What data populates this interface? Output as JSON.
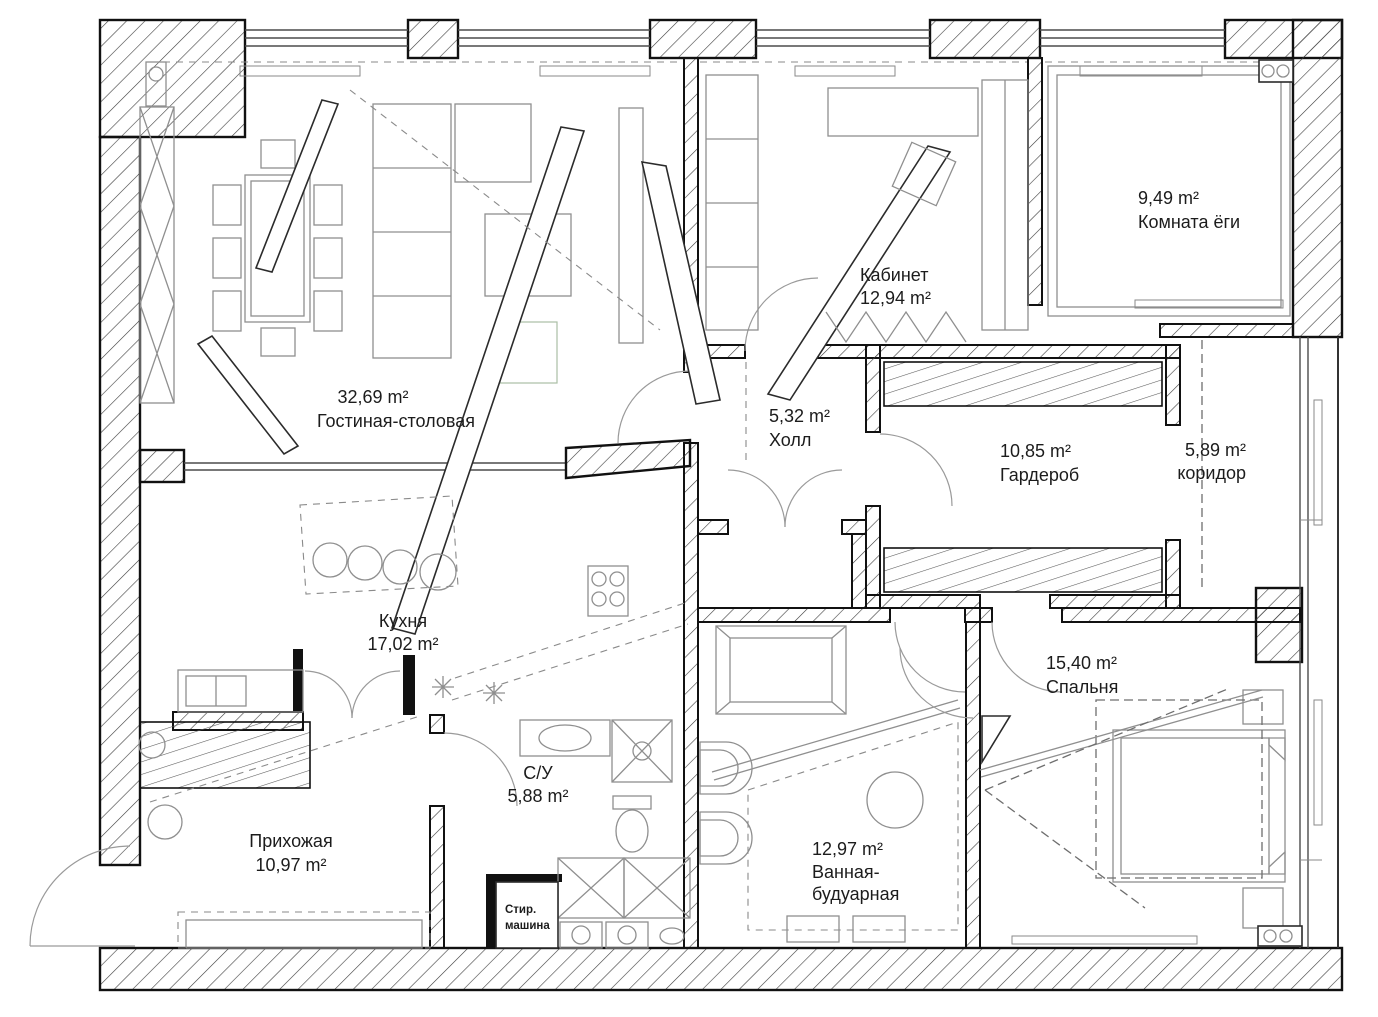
{
  "rooms": {
    "living": {
      "area": "32,69 m²",
      "name": "Гостиная-столовая"
    },
    "office": {
      "name": "Кабинет",
      "area": "12,94 m²"
    },
    "yoga": {
      "area": "9,49 m²",
      "name": "Комната ёги"
    },
    "hall": {
      "area": "5,32 m²",
      "name": "Холл"
    },
    "wardrobe": {
      "area": "10,85 m²",
      "name": "Гардероб"
    },
    "corridor": {
      "area": "5,89 m²",
      "name": "коридор"
    },
    "kitchen": {
      "name": "Кухня",
      "area": "17,02 m²"
    },
    "wc": {
      "name": "С/У",
      "area": "5,88 m²"
    },
    "entry": {
      "name": "Прихожая",
      "area": "10,97 m²"
    },
    "bedroom": {
      "area": "15,40 m²",
      "name": "Спальня"
    },
    "bath": {
      "area": "12,97 m²",
      "name_line1": "Ванная-",
      "name_line2": "будуарная"
    },
    "washer": {
      "line1": "Стир.",
      "line2": "машина"
    }
  },
  "colors": {
    "wall_line": "#111111",
    "furniture_line": "#8f8f8f",
    "text": "#1c1c1c",
    "background": "#ffffff"
  }
}
